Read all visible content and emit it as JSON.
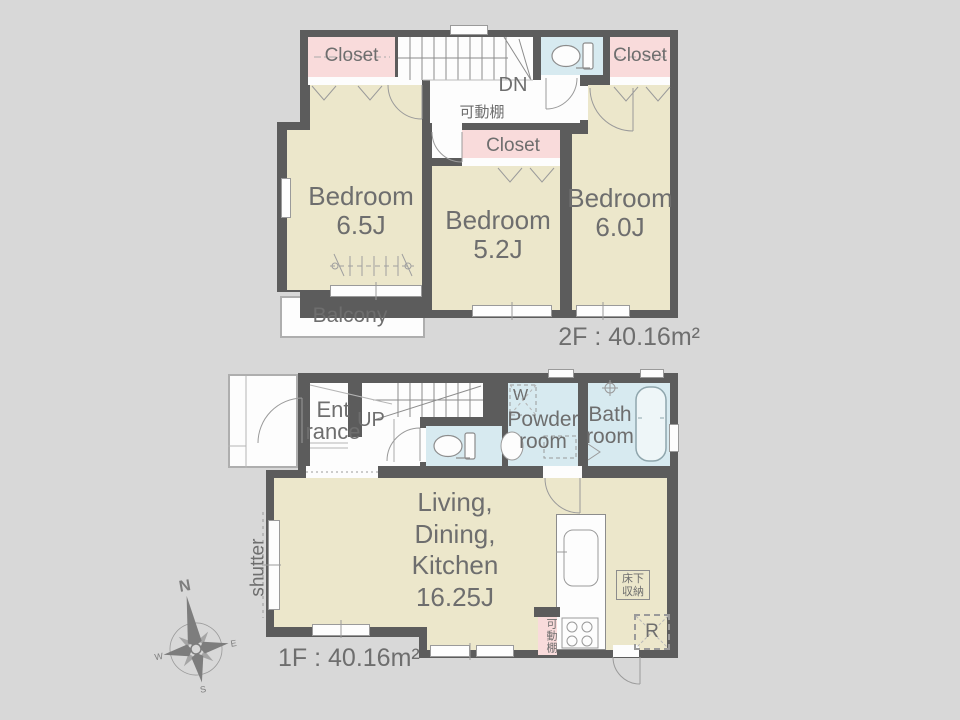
{
  "colors": {
    "bg": "#d8d8d8",
    "wall": "#5c5c5c",
    "room": "#ece7cb",
    "closet": "#f9dbdb",
    "wet": "#d7eaf0",
    "white": "#fdfdfd",
    "line": "#9a9a9a",
    "text": "#6e6e6e"
  },
  "floor2": {
    "closet_left": "Closet",
    "closet_mid": "Closet",
    "closet_right": "Closet",
    "stairs_label": "DN",
    "shelf_label": "可動棚",
    "bedroom1": {
      "name": "Bedroom",
      "size": "6.5J"
    },
    "bedroom2": {
      "name": "Bedroom",
      "size": "5.2J"
    },
    "bedroom3": {
      "name": "Bedroom",
      "size": "6.0J"
    },
    "balcony": "Balcony",
    "area": "2F : 40.16m²"
  },
  "floor1": {
    "entrance": [
      "Ent",
      "rance"
    ],
    "stairs_label": "UP",
    "washer": "W",
    "powder": [
      "Powder",
      "room"
    ],
    "bath": [
      "Bath",
      "room"
    ],
    "ldk": [
      "Living,",
      "Dining,",
      "Kitchen",
      "16.25J"
    ],
    "shelf_label": "可動棚",
    "storage": [
      "床下",
      "収納"
    ],
    "fridge": "R",
    "shutter": "shutter",
    "area": "1F : 40.16m²"
  },
  "compass": {
    "n": "N",
    "e": "E",
    "s": "S",
    "w": "W"
  }
}
